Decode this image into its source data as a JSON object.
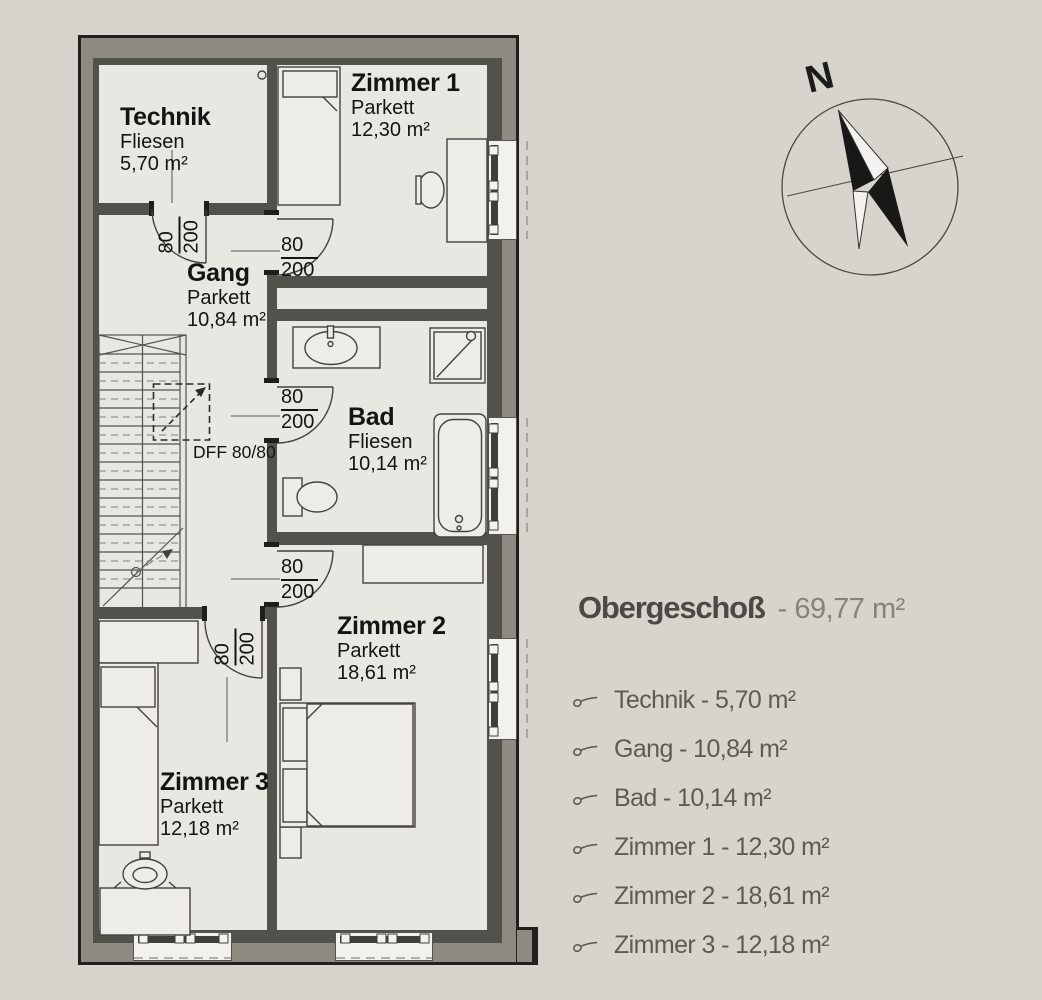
{
  "plan": {
    "rooms": {
      "technik": {
        "name": "Technik",
        "floor": "Fliesen",
        "area": "5,70 m²"
      },
      "zimmer1": {
        "name": "Zimmer 1",
        "floor": "Parkett",
        "area": "12,30 m²"
      },
      "gang": {
        "name": "Gang",
        "floor": "Parkett",
        "area": "10,84 m²"
      },
      "bad": {
        "name": "Bad",
        "floor": "Fliesen",
        "area": "10,14 m²"
      },
      "zimmer2": {
        "name": "Zimmer 2",
        "floor": "Parkett",
        "area": "18,61 m²"
      },
      "zimmer3": {
        "name": "Zimmer 3",
        "floor": "Parkett",
        "area": "12,18 m²"
      }
    },
    "doors": {
      "technik": {
        "width": "80",
        "height": "200"
      },
      "zimmer1": {
        "width": "80",
        "height": "200"
      },
      "bad": {
        "width": "80",
        "height": "200"
      },
      "zimmer2": {
        "width": "80",
        "height": "200"
      },
      "zimmer3": {
        "width": "80",
        "height": "200"
      }
    },
    "roof_window_label": "DFF 80/80",
    "compass": {
      "north_label": "N"
    }
  },
  "legend": {
    "title": "Obergeschoß",
    "total_area": "- 69,77 m²",
    "items": [
      {
        "label": "Technik - 5,70 m²"
      },
      {
        "label": "Gang - 10,84 m²"
      },
      {
        "label": "Bad - 10,14 m²"
      },
      {
        "label": "Zimmer 1 - 12,30 m²"
      },
      {
        "label": "Zimmer 2 - 18,61 m²"
      },
      {
        "label": "Zimmer 3 - 12,18 m²"
      }
    ]
  },
  "colors": {
    "background": "#d7d4cd",
    "floor": "#e9e7e2",
    "wall_outer": "#8d8a82",
    "wall_inner": "#53514c",
    "line": "#21201e"
  }
}
